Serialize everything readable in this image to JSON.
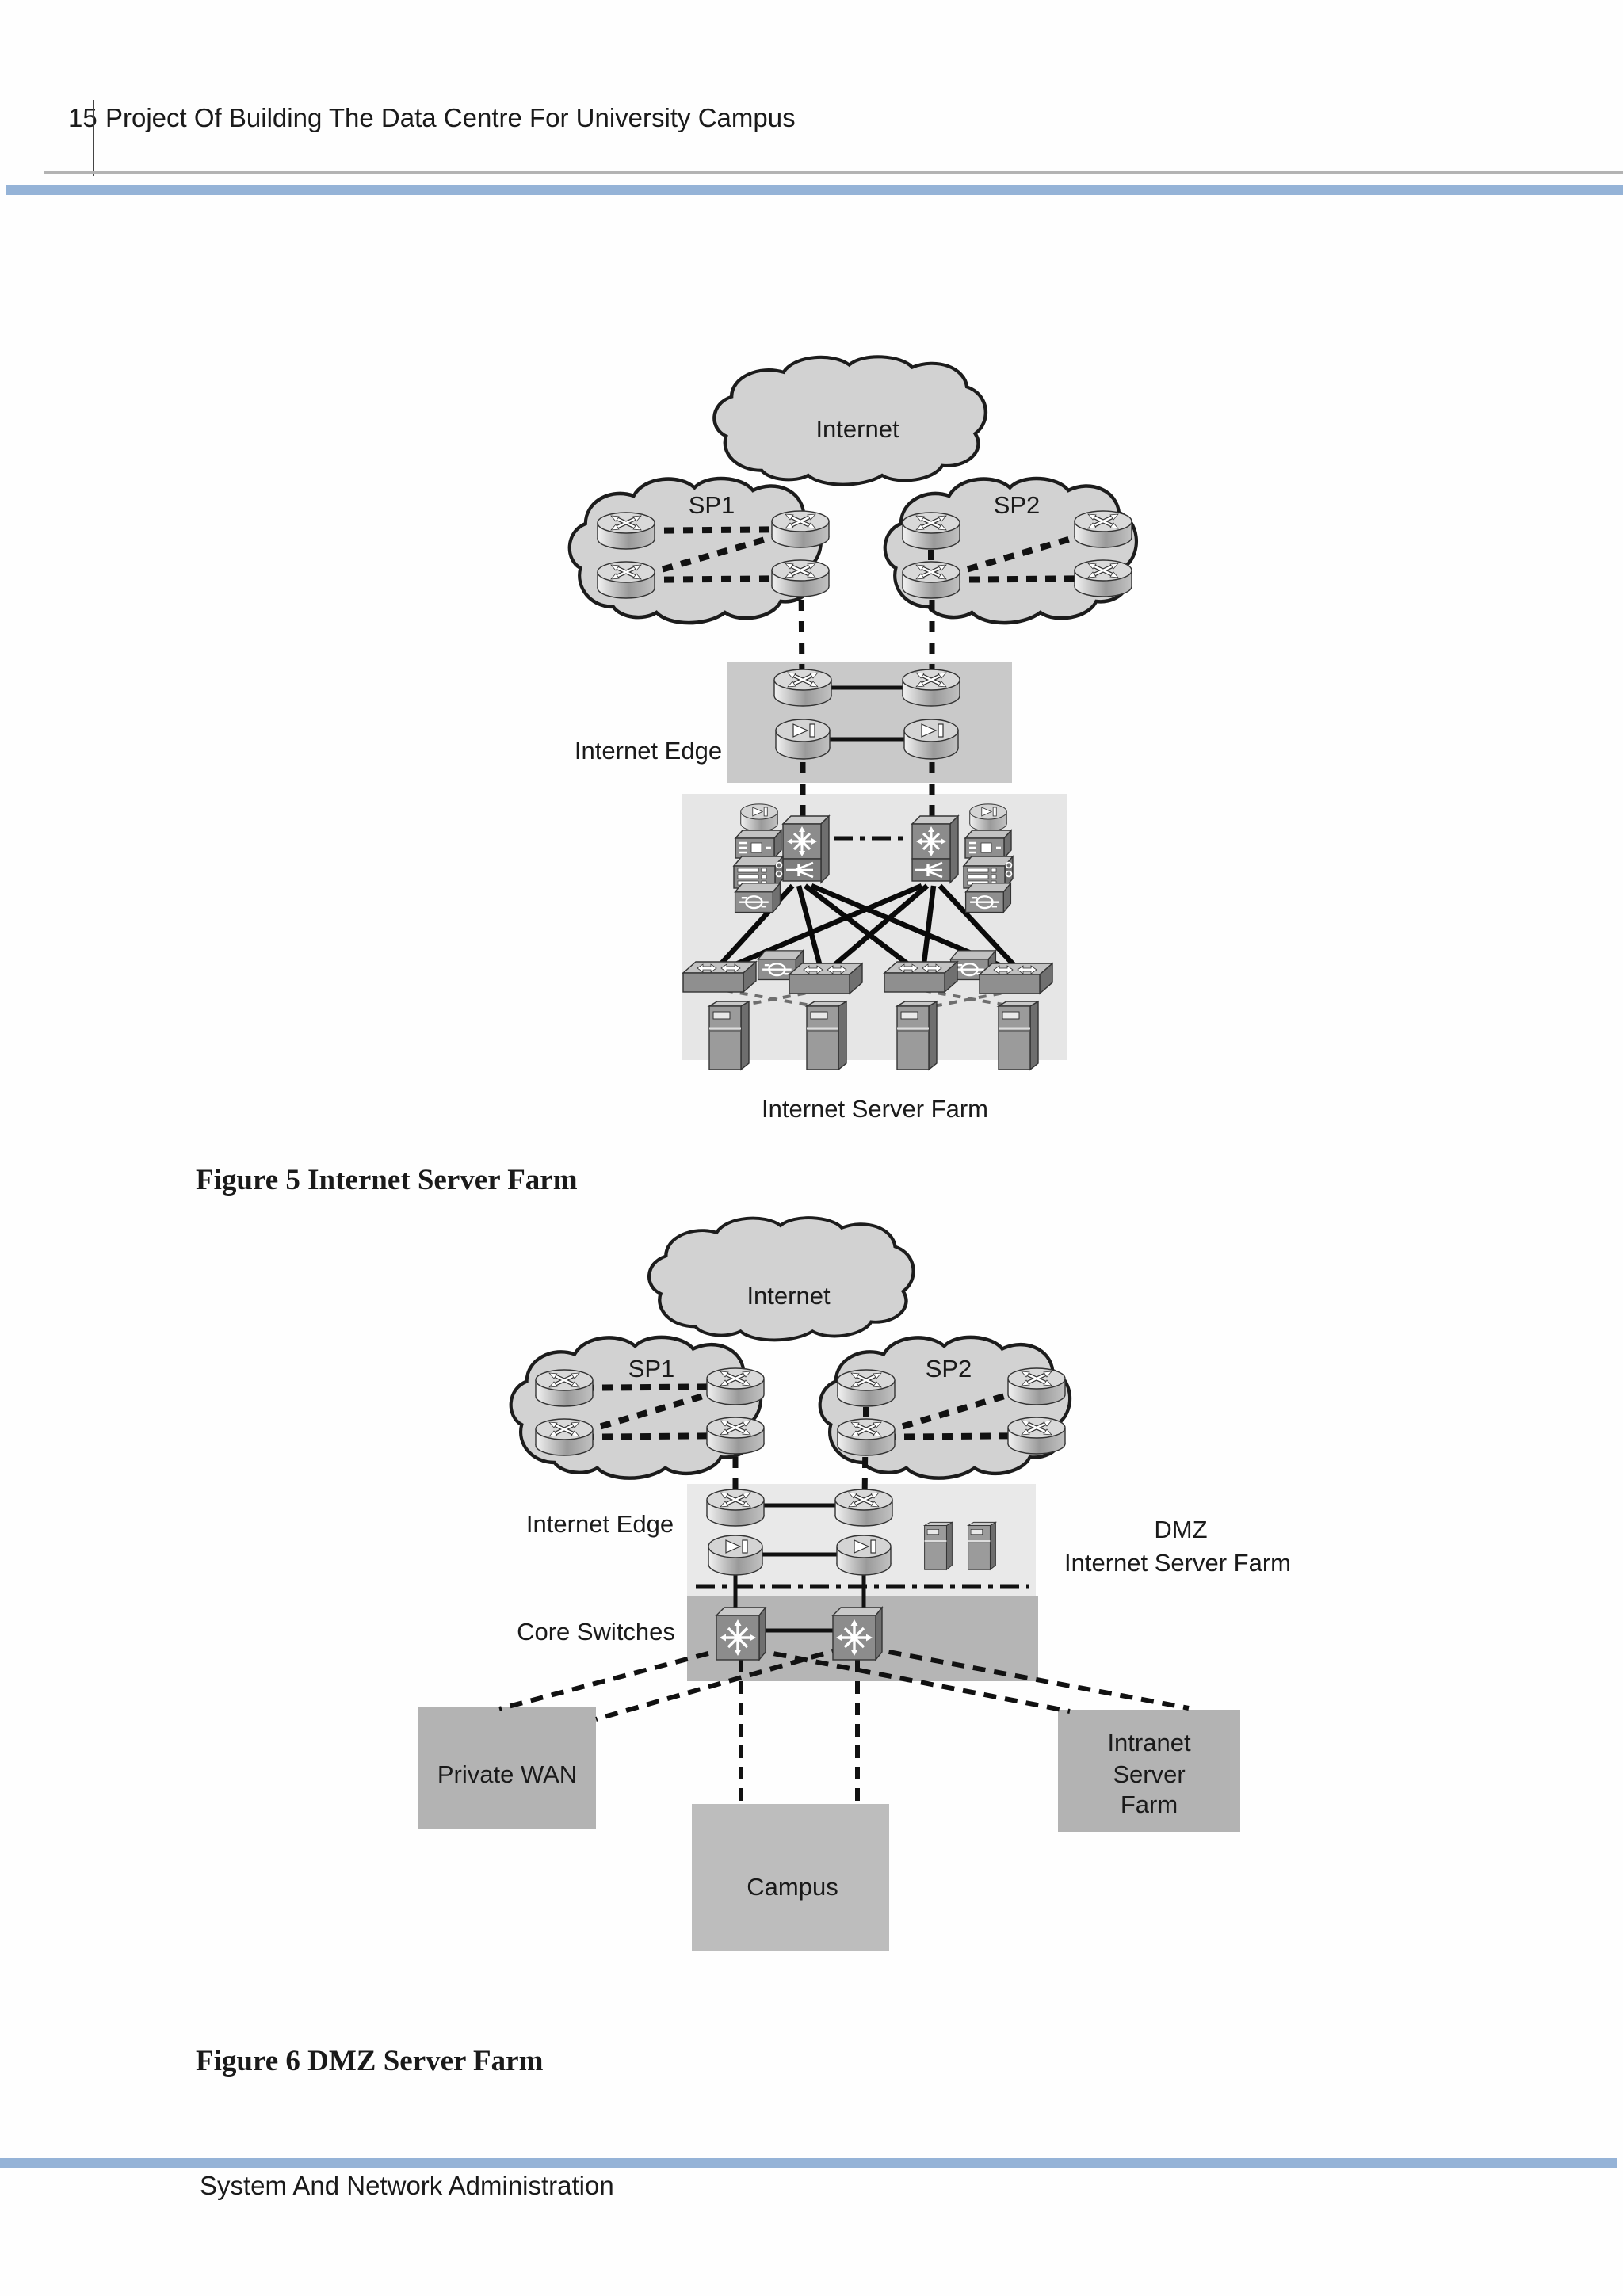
{
  "page": {
    "number": "15",
    "title": "Project Of Building The Data Centre For University Campus",
    "footer": "System And Network Administration"
  },
  "figure5": {
    "caption": "Figure 5 Internet Server Farm",
    "labels": {
      "internet": "Internet",
      "sp1": "SP1",
      "sp2": "SP2",
      "internet_edge": "Internet Edge",
      "server_farm": "Internet Server Farm"
    }
  },
  "figure6": {
    "caption": "Figure 6 DMZ Server Farm",
    "labels": {
      "internet": "Internet",
      "sp1": "SP1",
      "sp2": "SP2",
      "internet_edge": "Internet Edge",
      "dmz": [
        "DMZ",
        "Internet Server Farm"
      ],
      "core_switches": "Core Switches",
      "private_wan": "Private WAN",
      "campus": "Campus",
      "intranet": [
        "Intranet",
        "Server",
        "Farm"
      ]
    }
  },
  "colors": {
    "accent_bar": "#95b3d7",
    "header_rule": "#b3b3b3",
    "cloud_fill": "#d2d2d2",
    "edge_box": "#c9c9c9",
    "farm_box": "#e6e6e6",
    "dmz_edge_box": "#e9e9e9",
    "core_box": "#b5b5b5",
    "zone_box": "#b3b3b3",
    "text": "#1a1a1a"
  }
}
